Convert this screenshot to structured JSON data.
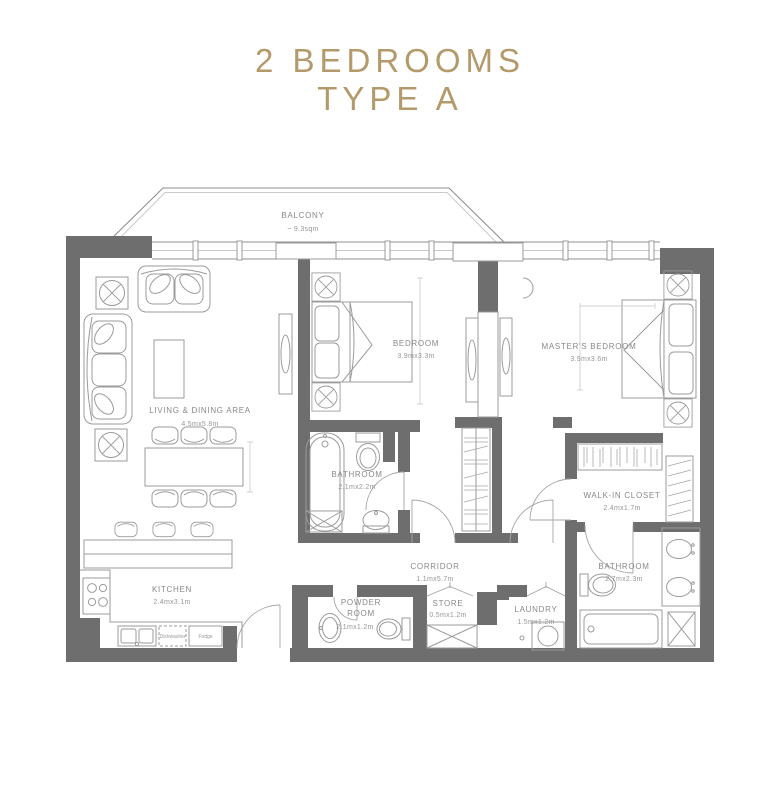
{
  "title": {
    "line1": "2 BEDROOMS",
    "line2": "TYPE A"
  },
  "colors": {
    "accent_gold": "#b49a6a",
    "wall_gray": "#6e6e6e",
    "furniture_gray": "#9b9b9b",
    "label_gray": "#898989"
  },
  "rooms": {
    "balcony": {
      "name": "BALCONY",
      "area": "~ 9.3sqm"
    },
    "living_dining": {
      "name": "LIVING & DINING AREA",
      "dims": "4.5mx5.8m"
    },
    "bedroom": {
      "name": "BEDROOM",
      "dims": "3.9mx3.3m"
    },
    "master_bedroom": {
      "name": "MASTER'S BEDROOM",
      "dims": "3.9mx3.6m"
    },
    "bathroom_1": {
      "name": "BATHROOM",
      "dims": "2.1mx2.2m"
    },
    "walk_in_closet": {
      "name": "WALK-IN CLOSET",
      "dims": "2.4mx1.7m"
    },
    "corridor": {
      "name": "CORRIDOR",
      "dims": "1.1mx5.7m"
    },
    "kitchen": {
      "name": "KITCHEN",
      "dims": "2.4mx3.1m"
    },
    "bathroom_2": {
      "name": "BATHROOM",
      "dims": "2.7mx2.3m"
    },
    "powder_room": {
      "name_line1": "POWDER",
      "name_line2": "ROOM",
      "dims": "2.1mx1.2m"
    },
    "store": {
      "name": "STORE",
      "dims": "0.5mx1.2m"
    },
    "laundry": {
      "name": "LAUNDRY",
      "dims": "1.5mx1.2m"
    }
  },
  "appliances": {
    "dishwasher": "Dishwasher",
    "fridge": "Fridge"
  }
}
